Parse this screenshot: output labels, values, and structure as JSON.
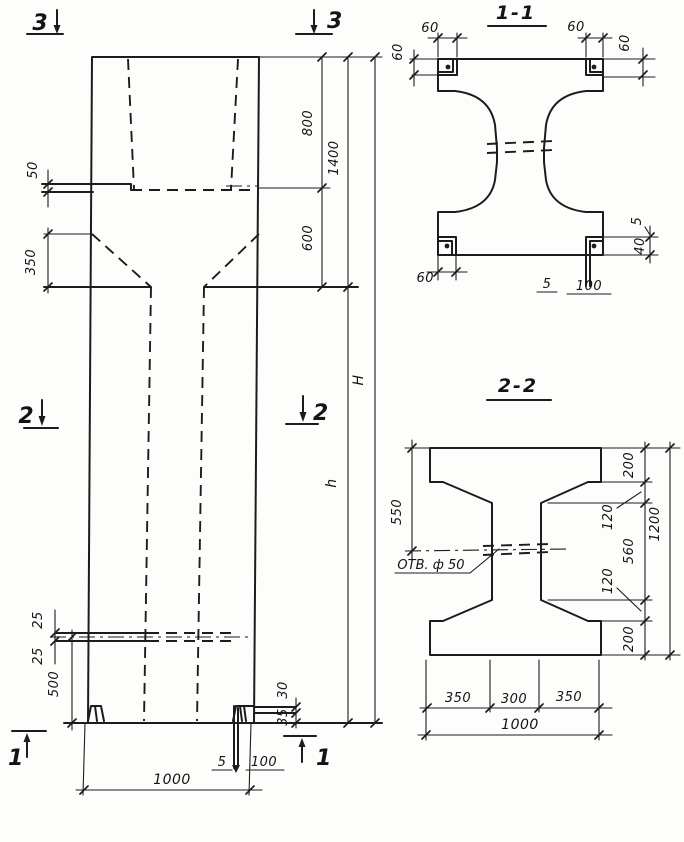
{
  "drawing_type": "column elevation with sections",
  "colors": {
    "ink": "#1c1c1c",
    "paper": "#fdfdfb"
  },
  "elev": {
    "marker_3_left": "3",
    "marker_3_right": "3",
    "marker_2_left": "2",
    "marker_2_right": "2",
    "marker_1_left": "1",
    "marker_1_right": "1",
    "d50": "50",
    "d350": "350",
    "d800": "800",
    "d600": "600",
    "d1400": "1400",
    "dH": "H",
    "dh": "h",
    "d25_top": "25",
    "d25_bot": "25",
    "d500": "500",
    "d1000": "1000",
    "d5": "5",
    "d100": "100",
    "d30": "30",
    "d35": "35"
  },
  "s11": {
    "title": "1-1",
    "d60_tl": "60",
    "d60_tr": "60",
    "d60_left": "60",
    "d60_right": "60",
    "d60_bl": "60",
    "d5_bottom": "5",
    "d100_bottom": "100",
    "d5_right": "5",
    "d40_right": "40"
  },
  "s22": {
    "title": "2-2",
    "hole_label": "ОТВ. ф 50",
    "d550": "550",
    "d200_top": "200",
    "d120_top": "120",
    "d560": "560",
    "d120_bot": "120",
    "d200_bot": "200",
    "d1200": "1200",
    "d350_left": "350",
    "d300": "300",
    "d350_right": "350",
    "d1000": "1000"
  }
}
